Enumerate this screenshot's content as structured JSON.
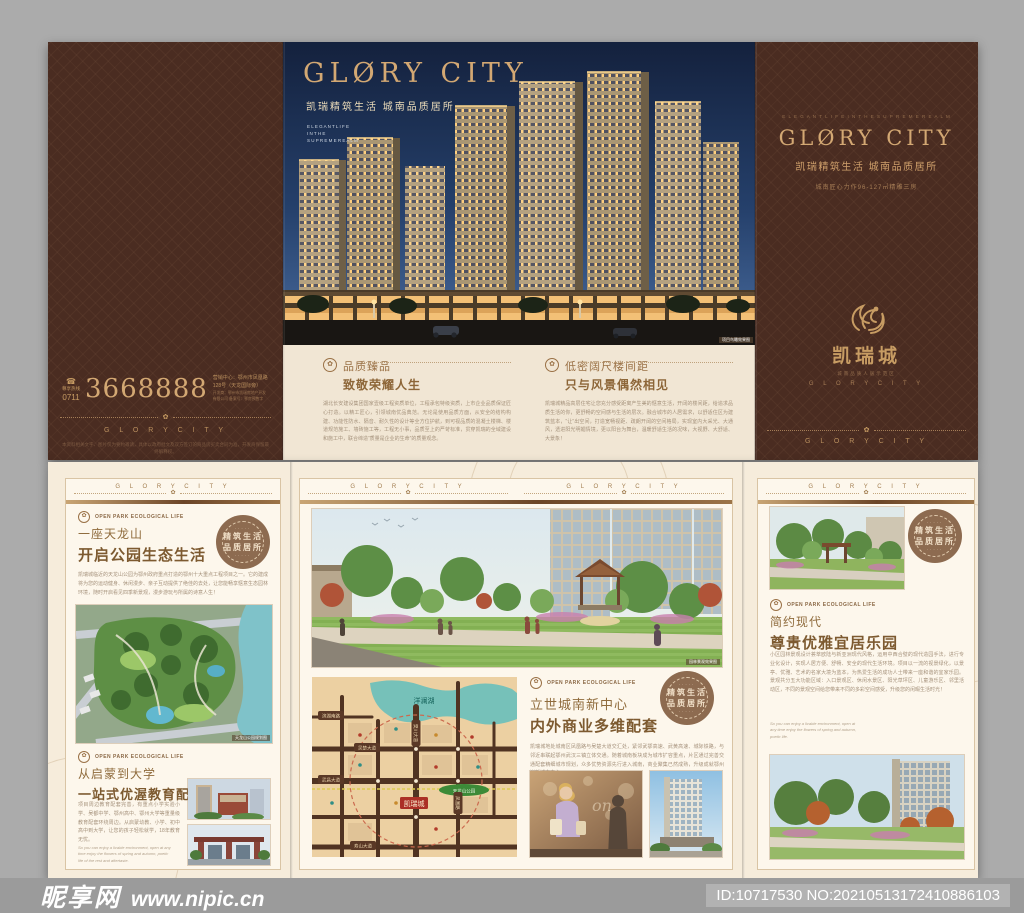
{
  "watermark": {
    "site_name": "昵享网",
    "site_url": "www.nipic.cn",
    "image_id": "ID:10717530 NO:20210513172410886103"
  },
  "icons": {
    "emblem": "✿",
    "phone": "☎",
    "star": "★",
    "stamp_dots": "·····"
  },
  "brand": {
    "deco_title": "GLØRY CITY",
    "spaced_title": "G L O R Y   C I T Y",
    "tagline_cn": "凯瑞精筑生活  城南品质居所",
    "tagline_en": "E L E G A N T  L I F E  I N  T H E  S U P R E M E  R E A L M",
    "spec": "城南匠心力作96-127㎡精雕三房",
    "logo_cn": "凯瑞城",
    "logo_sub": "城南品质人居示范区",
    "logo_en": "G L O R Y  C I T Y"
  },
  "outer": {
    "spread_overlay": {
      "en1": "E L E G A N T  L I F E",
      "en2": "I N  T H E",
      "en3": "S U P R E M E  R E A L M",
      "photo_caption": "项目鸟瞰效果图"
    },
    "sections": [
      {
        "title1": "品质臻品",
        "title2": "致敬荣耀人生",
        "body": "湖北长安建设集团国家壹级工程资质单位，工程承包特级资质，上市企业品质保证匠心打造。以精工匠心，引领城南优品典范。无论是使用品质方面，从安全的结构构建、功能性防水、隔音、耐久性的设计等全方位护航，到可视品质的混凝土楼梯、楼道规范施工、墙砖施工等，工程无小事，品质至上的严苛标准，贯穿凯瑞的全域建设和施工中，联合缔造“质量是企业的生命”的质量观念。"
      },
      {
        "title1": "低密阔尺楼间距",
        "title2": "只与风景偶然相见",
        "body": "凯瑞城精品高层住宅让您充分感受距离产生美的惬意生活，开阔的楼间距，给追求品质生活的你，更舒畅的空间感与生活的层次。融合城市的人居需求，以舒适住区为建筑蓝本，“让”出空间，打造宽畅视距、疏朗开阔的空间格局，实现室内大采光、大通风，透进阳光明媚情境，更以阳台为舞台，温暖舒适生活的况味，大视野、大舒适、大景象！"
      }
    ],
    "back": {
      "hotline_label": "尊享热线",
      "phone_area": "0711",
      "phone": "3668888",
      "address1": "营销中心：鄂州市凤凰路128号（天龙国际旁）",
      "address2": "开发商：鄂州市凯瑞房地产开发有限公司    备案号：鄂房预售字",
      "disclaimer": "本资料相关文字、图片仅为要约邀请，具体以政府批文及双方签订的商品房买卖合同为准，开发商保留最终解释权。"
    }
  },
  "inner": {
    "section_label": "OPEN PARK ECOLOGICAL LIFE",
    "stamp": {
      "l1": "精筑生活",
      "l2": "品质居所"
    },
    "left": {
      "s1_title1": "一座天龙山",
      "s1_title2": "开启公园生态生活",
      "s1_body": "凯瑞城临近的天龙山公园为鄂州政府重点打造的鄂州十大重点工程项目之一。它的建成将为您的运动健身、休闲漫步、亲子互动提供了绝佳的去处，让您能畅享惬意生态园林环境，随时开启看见四季新景观，漫步游玩与所属的诗意人生！",
      "aerial_caption": "天龙山公园规划图",
      "s2_title1": "从启蒙到大学",
      "s2_title2": "一站式优渥教育配套",
      "s2_body": "项目周边教育配套完善，有重点小学实验小学、吴都中学、鄂州高中、鄂州大学等重量级教育配套环绕周边。从启蒙幼教、小学、初中高中到大学，让您的孩子轻松就学，18年教育无忧。",
      "note_en": "So you can enjoy a livable environment, open at any time enjoy the flowers of spring and autumn, poetic life of the rest and aftertaste."
    },
    "center": {
      "park_caption": "园林景观效果图",
      "s1_title1": "立世城南新中心",
      "s1_title2": "内外商业多维配套",
      "s1_body": "凯瑞城地处城南区凤凰路与吴楚大道交汇处，紧邻武鄂高速、武黄高速、城际铁路，与邻近串联起鄂州武汉三镇立体交通。随着城南板块成为城市扩容重点，片区通过完善交通配套精细城市规划，众多优势资源先行进入城南，商业聚集已然成熟，升级成就鄂州崭新城市中心。",
      "map": {
        "lake": "洋澜湖",
        "park": "天龙山公园",
        "project": "凯瑞城",
        "road1": "滨湖南路",
        "road2": "吴楚大道",
        "road3": "武昌大道",
        "road4": "寿山大道",
        "road5": "樊川大道",
        "road6": "凤凰路"
      }
    },
    "right": {
      "s1_title1": "简约现代",
      "s1_title2": "尊贵优雅宜居乐园",
      "s1_body": "小区园林景观设计荟萃欧陆与新亚洲现代风格，运用中西合璧的现代造园手法，进行专业化设计，实现人居方便、舒畅、安全的现代生活环境。项目以一流的视景绿化，以景亭、优雅、艺术的名家大境为蓝本，为热爱生活的成功人士带来一座和谐的宜家乐园。景观共分五大功能区域：入口景观区、休闲水景区、阳光草坪区、儿童游乐区、邻里活动区，不同的景观空间给您带来不同的多彩空间感受，升级您的闲暇生活时光！",
      "note_en": "So you can enjoy a livable environment, open at any time enjoy the flowers of spring and autumn, poetic life."
    }
  }
}
